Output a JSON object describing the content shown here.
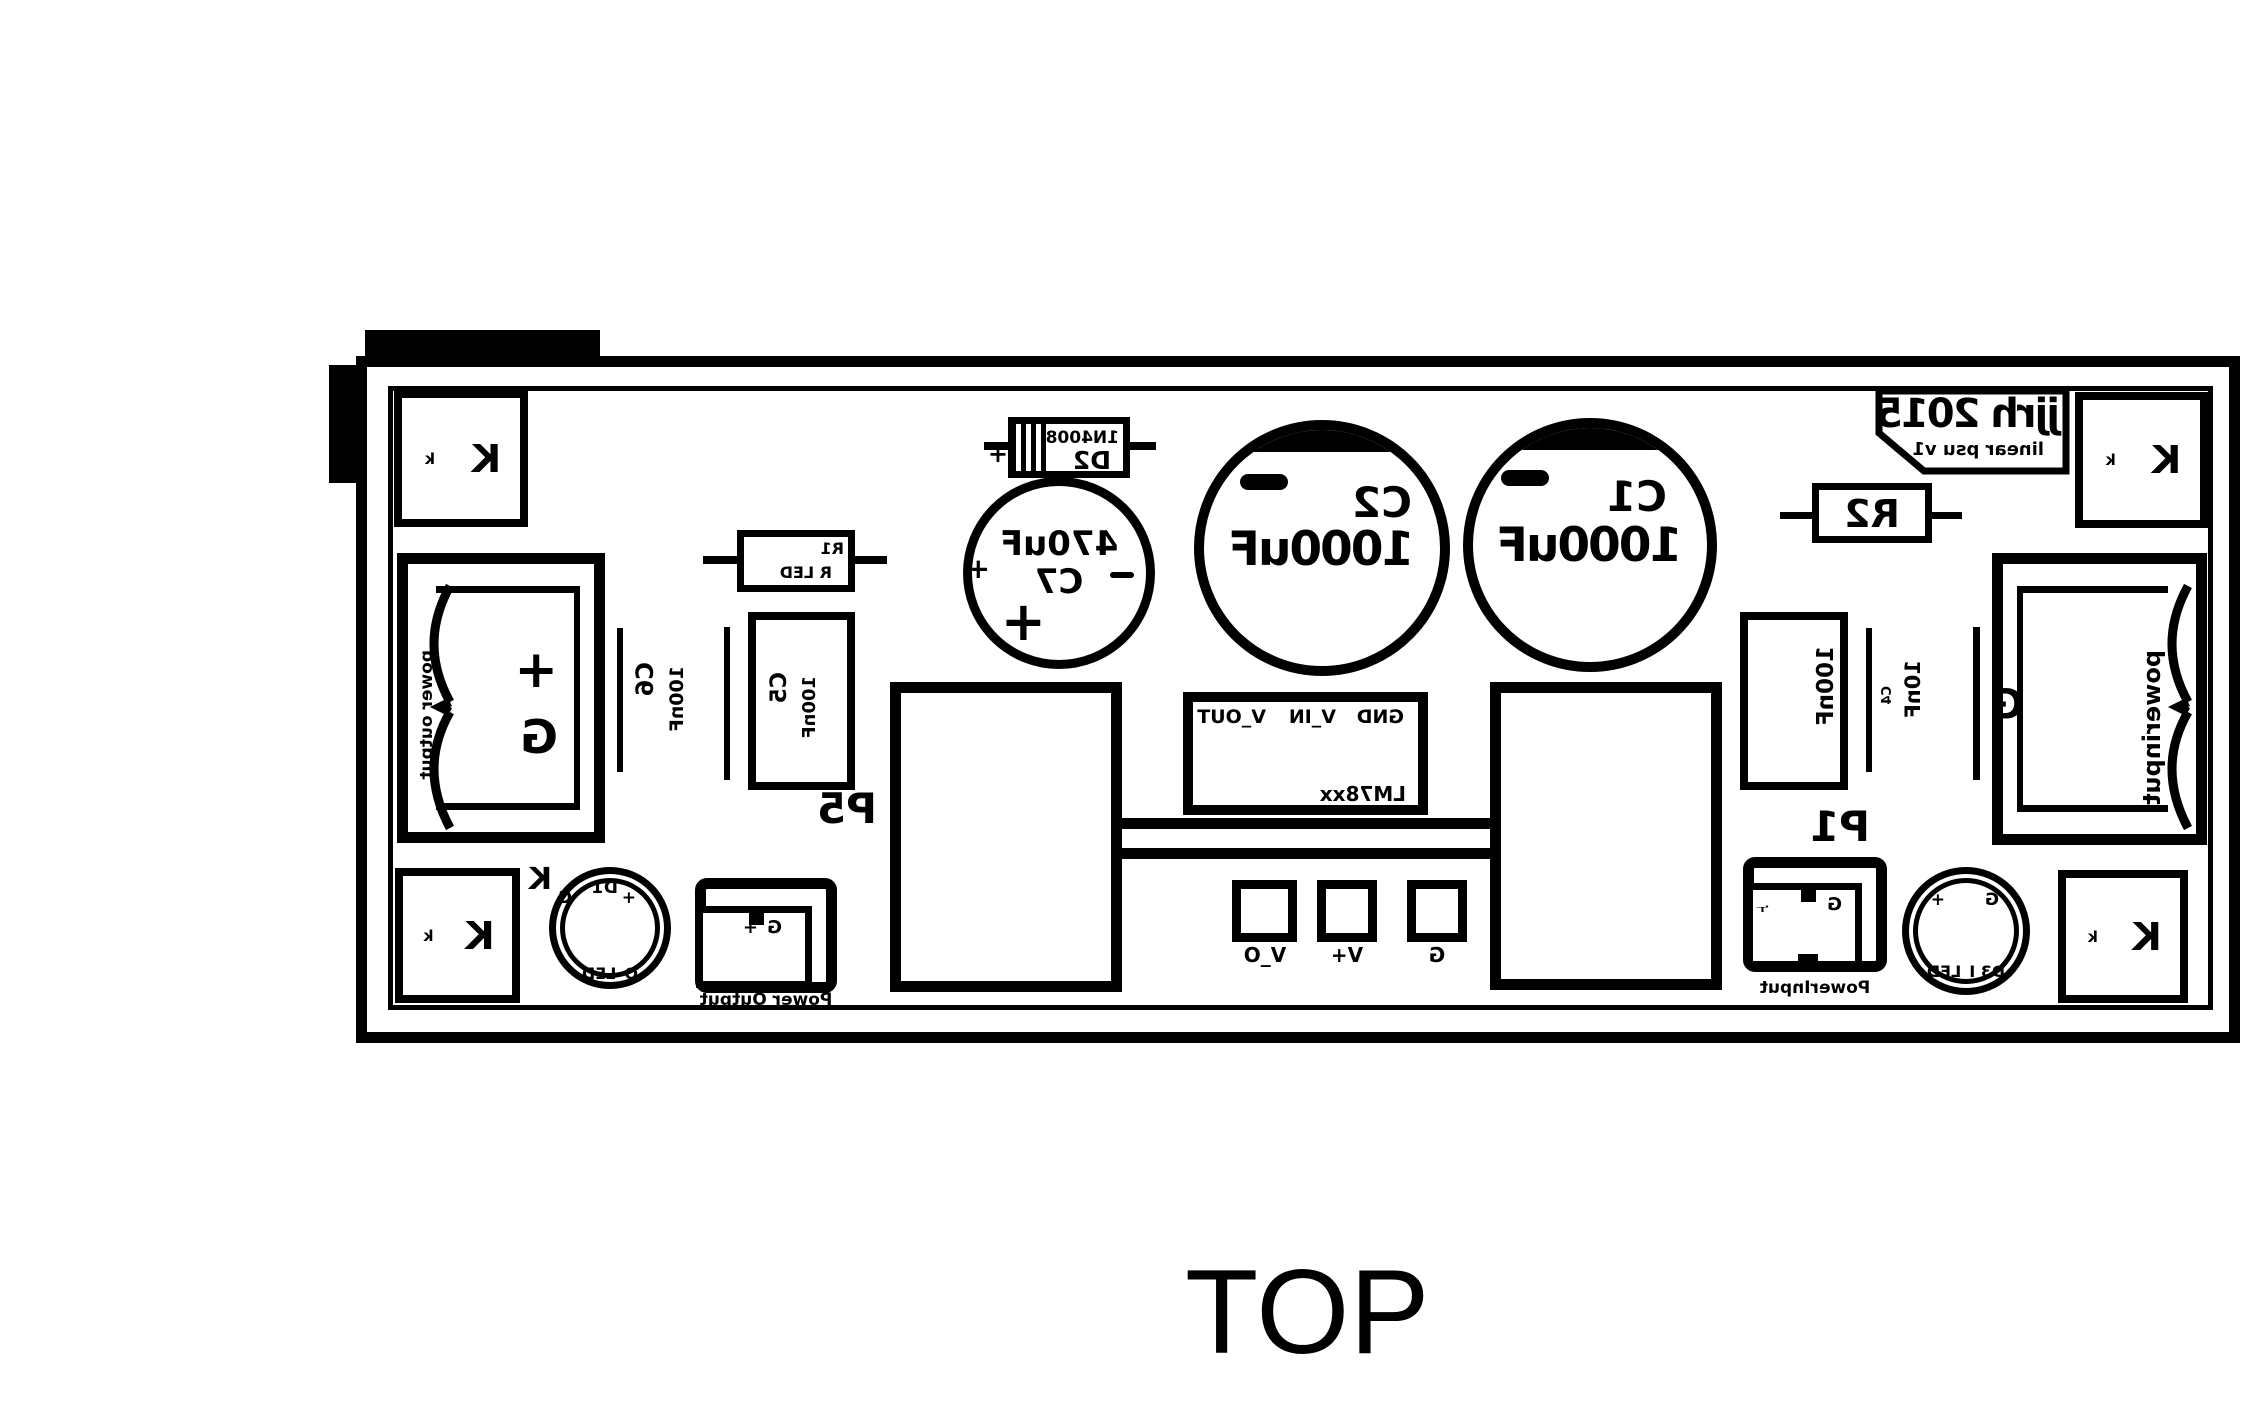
{
  "view": {
    "top_label": "TOP"
  },
  "board": {
    "logo": {
      "line1": "jjrh 2015",
      "line2": "linear psu v1"
    },
    "corner_pad": {
      "large": "K",
      "small": "k"
    },
    "annotations": {
      "k": "K"
    },
    "symbols": {
      "plus": "+",
      "minus": "−"
    },
    "components": {
      "c1": {
        "ref": "C1",
        "value": "1000uF"
      },
      "c2": {
        "ref": "C2",
        "value": "1000uF"
      },
      "c7": {
        "ref": "C7",
        "value": "470uF"
      },
      "c5": {
        "ref": "C5",
        "value": "100nF"
      },
      "c6": {
        "ref": "C6",
        "value": "100nF"
      },
      "c3": {
        "value": "100nF"
      },
      "c4": {
        "ref": "C4",
        "value": "10nF"
      },
      "r1": {
        "ref": "R1",
        "value": "R LED"
      },
      "r2": {
        "ref": "R2"
      },
      "d2": {
        "ref": "D2",
        "value": "1N4008"
      },
      "d1": {
        "ref": "D1",
        "label": "O_LED"
      },
      "d3": {
        "label": "D3 I_LED"
      },
      "regulator": {
        "ref": "LM78xx",
        "pins": [
          "GND",
          "V_IN",
          "V_OUT"
        ]
      }
    },
    "pads": {
      "g": "G",
      "vplus": "V+",
      "vo": "V_O"
    },
    "connectors": {
      "p5": {
        "ref": "P5",
        "label": "Power Output",
        "pin_g": "G",
        "pin_plus": "+"
      },
      "p1": {
        "ref": "P1",
        "label": "PowerInput",
        "pin_g": "G",
        "pin_plus": "+"
      },
      "power_output_block": {
        "label": "power output",
        "g": "G",
        "plus": "+"
      },
      "power_input_block": {
        "label": "powerinput",
        "g": "G"
      }
    }
  }
}
